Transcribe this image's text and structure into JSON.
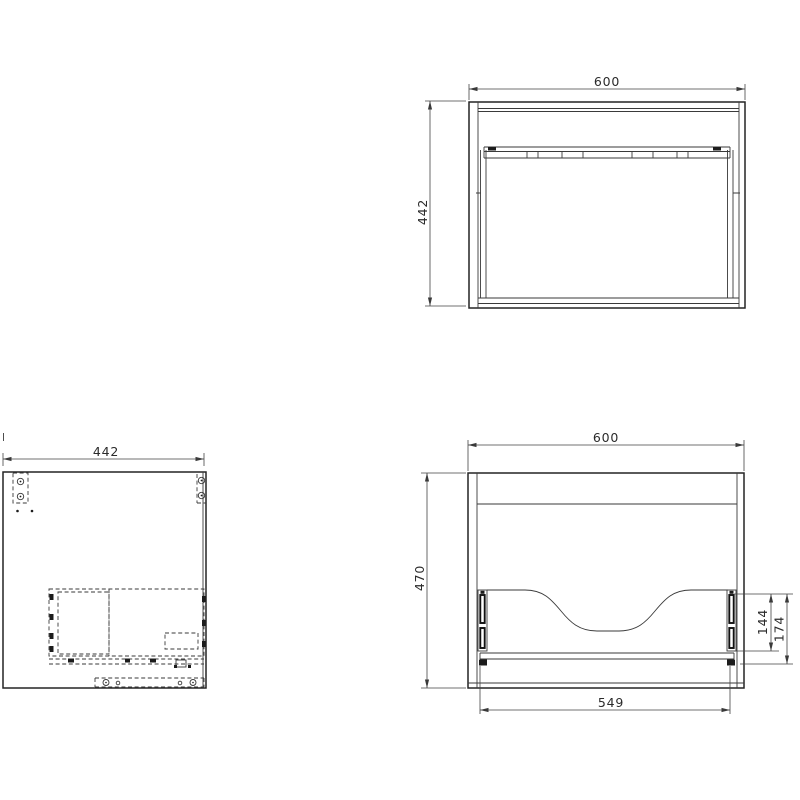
{
  "drawing": {
    "type": "technical-orthographic-views",
    "colors": {
      "background": "#ffffff",
      "line": "#2b2b2b"
    },
    "views": {
      "top": {
        "width": "600",
        "depth": "442"
      },
      "side": {
        "depth": "442"
      },
      "front": {
        "width": "600",
        "height": "470",
        "drawer_opening_width": "549",
        "slide_height": "144",
        "slide_to_rail_height": "174"
      }
    }
  }
}
